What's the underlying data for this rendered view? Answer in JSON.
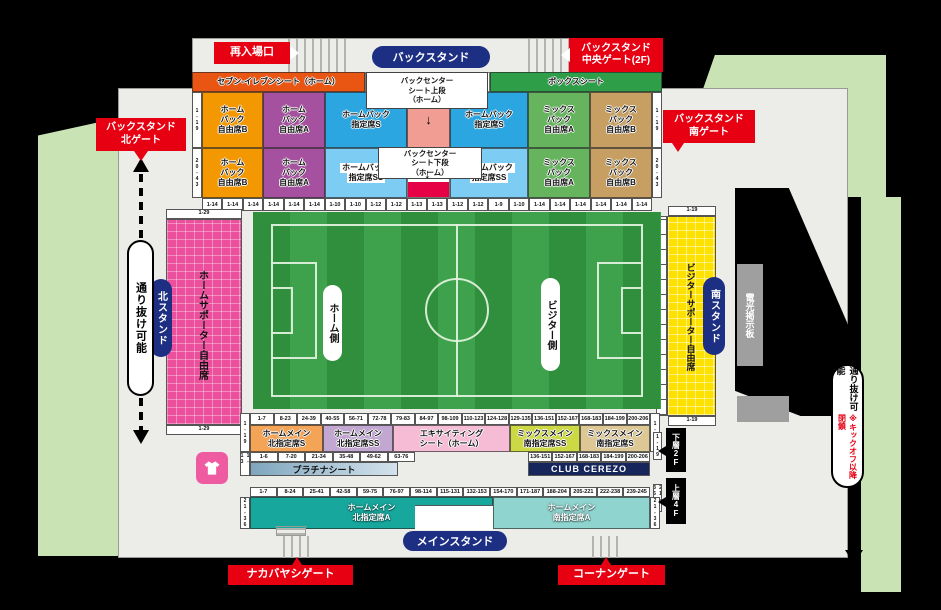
{
  "stadium": {
    "gates": {
      "reentry": "再入場口",
      "back_center": "バックスタンド\n中央ゲート(2F)",
      "back_north": "バックスタンド\n北ゲート",
      "back_south": "バックスタンド\n南ゲート",
      "nakabayashi": "ナカバヤシゲート",
      "konan": "コーナンゲート"
    },
    "stands": {
      "back": "バックスタンド",
      "main": "メインスタンド",
      "north": "北スタンド",
      "south": "南スタンド"
    },
    "passages": {
      "left": "通り抜け可能",
      "right": "通り抜け可能",
      "right_note": "※キックオフ以降閉鎖"
    },
    "field": {
      "home": "ホーム側",
      "visitor": "ビジター側"
    },
    "scoreboard": "電光掲示板",
    "floors": {
      "lower": "下層2F",
      "upper": "上層4F",
      "lower_rows": "1-19",
      "upper_rows": "21-36"
    },
    "north_stand": {
      "label": "ホームサポーター自由席",
      "rows_top": "1-29",
      "rows_bottom": "1-29"
    },
    "south_stand": {
      "label": "ビジターサポーター自由席",
      "rows_top": "1-19",
      "rows_bottom": "1-19"
    }
  },
  "back_stand": {
    "rows_range_upper": "1-19",
    "rows_range_lower": "20-43",
    "center_upper_label": [
      "バックセンター",
      "シート上段",
      "（ホーム）"
    ],
    "center_lower_label": [
      "バックセンター",
      "シート下段",
      "（ホーム）"
    ],
    "top_band": [
      {
        "n": "seven-eleven-seat",
        "w": 173,
        "bg": "#e95513",
        "lines": [
          "セブン-イレブンシート（ホーム）"
        ],
        "inter": true
      },
      {
        "n": "back-center-upper-head",
        "w": 125,
        "bg": "#ffffff",
        "lines": [],
        "inter": false
      },
      {
        "n": "box-seat",
        "w": 172,
        "bg": "#2f9e49",
        "lines": [
          "ボックスシート"
        ],
        "inter": true
      }
    ],
    "upper_row": [
      {
        "n": "home-back-free-b",
        "w": 61,
        "bg": "#f39800",
        "lines": [
          "ホーム",
          "バック",
          "自由席B"
        ],
        "inter": true
      },
      {
        "n": "home-back-free-a",
        "w": 62,
        "bg": "#a6519f",
        "lines": [
          "ホーム",
          "バック",
          "自由席A"
        ],
        "inter": true
      },
      {
        "n": "home-back-reserved-s",
        "w": 82,
        "bg": "#2ca6e0",
        "lines": [
          "ホームバック",
          "指定席S"
        ],
        "inter": true
      },
      {
        "n": "back-center-upper",
        "w": 43,
        "bg": "#f29d93",
        "cls": "pad-top",
        "arrow": true,
        "inter": true
      },
      {
        "n": "home-back-reserved-s",
        "w": 78,
        "bg": "#2ca6e0",
        "lines": [
          "ホームバック",
          "指定席S"
        ],
        "inter": true
      },
      {
        "n": "mix-back-free-a",
        "w": 62,
        "bg": "#67b45f",
        "lines": [
          "ミックス",
          "バック",
          "自由席A"
        ],
        "inter": true
      },
      {
        "n": "mix-back-free-b",
        "w": 62,
        "bg": "#c79f62",
        "lines": [
          "ミックス",
          "バック",
          "自由席B"
        ],
        "inter": true
      }
    ],
    "lower_row": [
      {
        "n": "home-back-free-b",
        "w": 61,
        "bg": "#f39800",
        "lines": [
          "ホーム",
          "バック",
          "自由席B"
        ],
        "inter": true
      },
      {
        "n": "home-back-free-a",
        "w": 62,
        "bg": "#a6519f",
        "lines": [
          "ホーム",
          "バック",
          "自由席A"
        ],
        "inter": true
      },
      {
        "n": "home-back-reserved-ss",
        "w": 82,
        "bg": "#7dccf3",
        "lines": [
          "ホームバック",
          "指定席SS"
        ],
        "chip": true,
        "inter": true
      },
      {
        "n": "back-center-lower",
        "w": 43,
        "bg": "#ffffff",
        "bar": "#e60045",
        "inter": true
      },
      {
        "n": "home-back-reserved-ss",
        "w": 78,
        "bg": "#7dccf3",
        "lines": [
          "ホームバック",
          "指定席SS"
        ],
        "chip": true,
        "inter": true
      },
      {
        "n": "mix-back-free-a",
        "w": 62,
        "bg": "#67b45f",
        "lines": [
          "ミックス",
          "バック",
          "自由席A"
        ],
        "inter": true
      },
      {
        "n": "mix-back-free-b",
        "w": 62,
        "bg": "#c79f62",
        "lines": [
          "ミックス",
          "バック",
          "自由席B"
        ],
        "inter": true
      }
    ],
    "seat_numbers": [
      "1-14",
      "1-14",
      "1-14",
      "1-14",
      "1-14",
      "1-14",
      "1-10",
      "1-10",
      "1-12",
      "1-12",
      "1-13",
      "1-13",
      "1-12",
      "1-12",
      "1-9",
      "1-10",
      "1-14",
      "1-14",
      "1-14",
      "1-14",
      "1-14",
      "1-14"
    ]
  },
  "main_stand": {
    "rows_range_left": "1-19",
    "rows_range_right": "1-19",
    "platinum_rows": "1-13",
    "a_rows_left": "21-36",
    "a_rows_right": "21-36",
    "seat_numbers_upper": [
      "1-7",
      "8-23",
      "24-39",
      "40-55",
      "56-71",
      "72-78",
      "79-83",
      "84-97",
      "98-109",
      "110-123",
      "124-128",
      "129-135",
      "136-151",
      "152-167",
      "168-183",
      "184-199",
      "200-206"
    ],
    "blocks": [
      {
        "n": "home-main-north-reserved-s",
        "w": 73,
        "bg": "#f3a457",
        "lines": [
          "ホームメイン",
          "北指定席S"
        ],
        "inter": true
      },
      {
        "n": "home-main-north-reserved-ss",
        "w": 70,
        "bg": "#c2a7d3",
        "lines": [
          "ホームメイン",
          "北指定席SS"
        ],
        "inter": true
      },
      {
        "n": "exciting-seat-home",
        "w": 117,
        "bg": "#f6bcd6",
        "lines": [
          "エキサイティング",
          "シート（ホーム）"
        ],
        "inter": true
      },
      {
        "n": "mix-main-south-reserved-ss",
        "w": 70,
        "bg": "#ccd944",
        "lines": [
          "ミックスメイン",
          "南指定席SS"
        ],
        "inter": true
      },
      {
        "n": "mix-main-south-reserved-s",
        "w": 70,
        "bg": "#dcc795",
        "lines": [
          "ミックスメイン",
          "南指定席S"
        ],
        "inter": true
      }
    ],
    "numbers_left": [
      "1-6",
      "7-20",
      "21-34",
      "35-48",
      "49-62",
      "63-76"
    ],
    "numbers_right": [
      "136-151",
      "152-167",
      "168-183",
      "184-199",
      "200-206"
    ],
    "platinum": "プラチナシート",
    "club": "CLUB CEREZO",
    "seat_numbers_lower": [
      "1-7",
      "8-24",
      "25-41",
      "42-58",
      "59-75",
      "76-97",
      "98-114",
      "115-131",
      "132-153",
      "154-170",
      "171-187",
      "188-204",
      "205-221",
      "222-238",
      "239-245"
    ],
    "north_a": {
      "lines": [
        "ホームメイン",
        "北指定席A"
      ]
    },
    "south_a": {
      "lines": [
        "ホームメイン",
        "南指定席A"
      ]
    }
  }
}
